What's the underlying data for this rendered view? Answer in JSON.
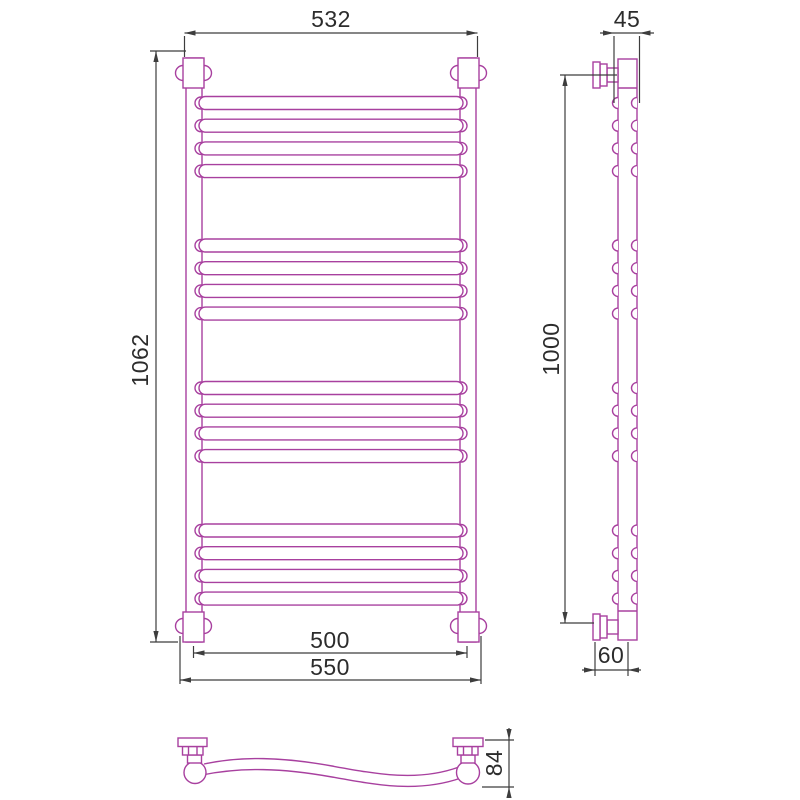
{
  "drawing": {
    "type": "technical-drawing",
    "subject": "heated towel rail - three orthographic views",
    "colors": {
      "product_outline": "#a8409f",
      "dimension_lines": "#3d3d3d",
      "dimension_text": "#2c2c2c",
      "background": "#ffffff"
    },
    "front_view": {
      "dim_width_top": "532",
      "dim_height": "1062",
      "dim_width_rail_axes": "500",
      "dim_width_overall": "550",
      "rung_groups": 4,
      "rungs_per_group": 4,
      "total_rungs": 16
    },
    "side_view": {
      "dim_depth_top": "45",
      "dim_height_mounts": "1000",
      "dim_depth_bottom": "60"
    },
    "bottom_view": {
      "dim_rung_depth": "84"
    }
  }
}
